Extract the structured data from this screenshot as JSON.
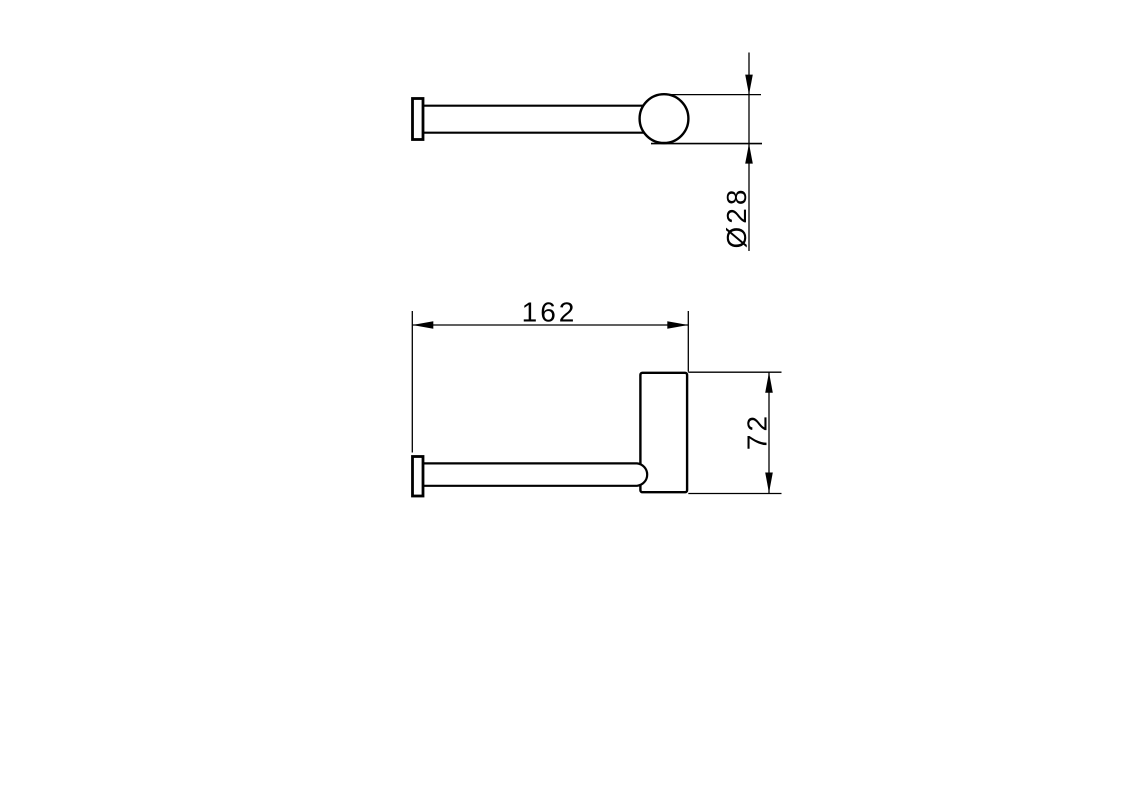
{
  "colors": {
    "background": "#ffffff",
    "line": "#000000"
  },
  "top_view": {
    "diameter_label": "Ø28"
  },
  "front_view": {
    "width_label": "162",
    "height_label": "72"
  }
}
